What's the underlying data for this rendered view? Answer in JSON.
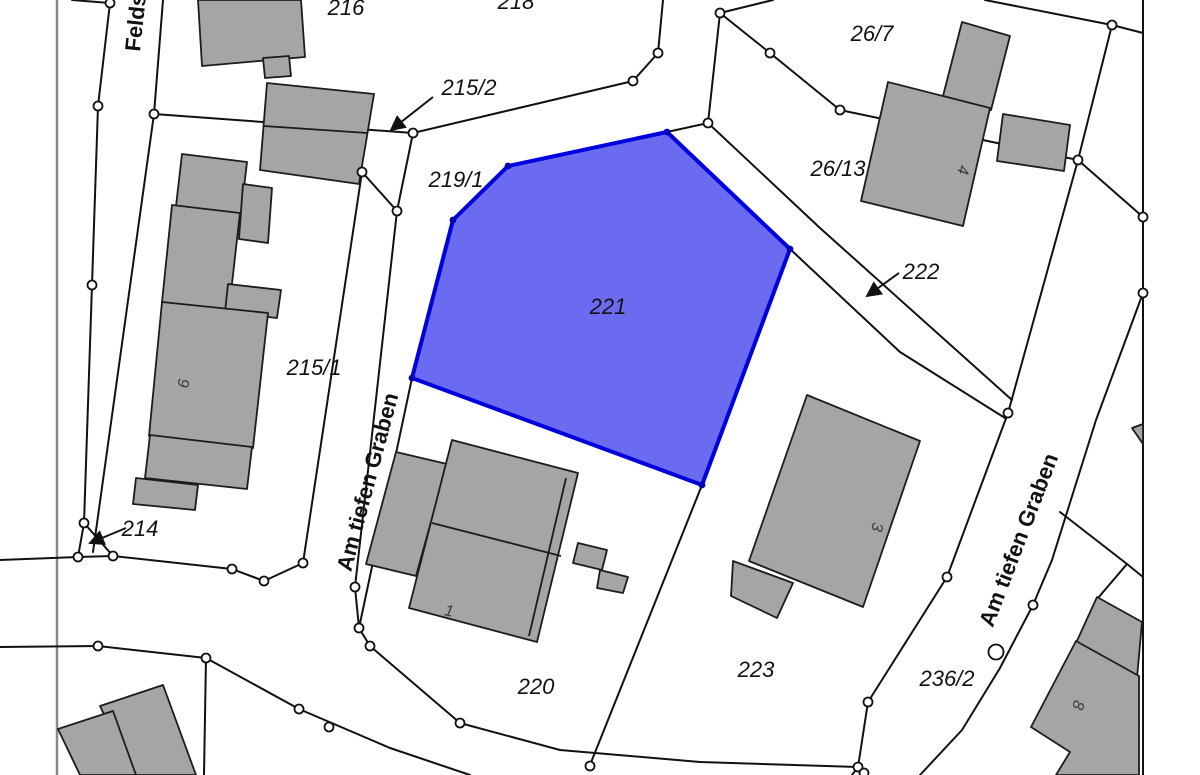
{
  "map": {
    "type": "cadastral-parcel-map",
    "selected_parcel": {
      "label": "221"
    },
    "parcel_labels": {
      "p216": "216",
      "p218": "218",
      "p215_2": "215/2",
      "p219_1": "219/1",
      "p215_1": "215/1",
      "p214": "214",
      "p220": "220",
      "p221": "221",
      "p223": "223",
      "p236_2": "236/2",
      "p26_7": "26/7",
      "p26_13": "26/13",
      "p222": "222"
    },
    "street_labels": {
      "feldstrasse": "Feldstraße",
      "am_tiefen_graben_left": "Am tiefen Graben",
      "am_tiefen_graben_right": "Am tiefen Graben"
    },
    "building_numbers": {
      "b1": "1",
      "b3": "3",
      "b4": "4",
      "b8": "8",
      "b9": "9"
    },
    "colors": {
      "background": "#ffffff",
      "boundary_line": "#111111",
      "frame_line": "#8a8a8a",
      "building_fill": "#a5a5a5",
      "building_stroke": "#1c1c1c",
      "highlight_fill": "#5e5ef0",
      "highlight_stroke": "#0000dd",
      "highlight_vertex": "#0000b4",
      "vertex_fill": "#ffffff"
    }
  }
}
